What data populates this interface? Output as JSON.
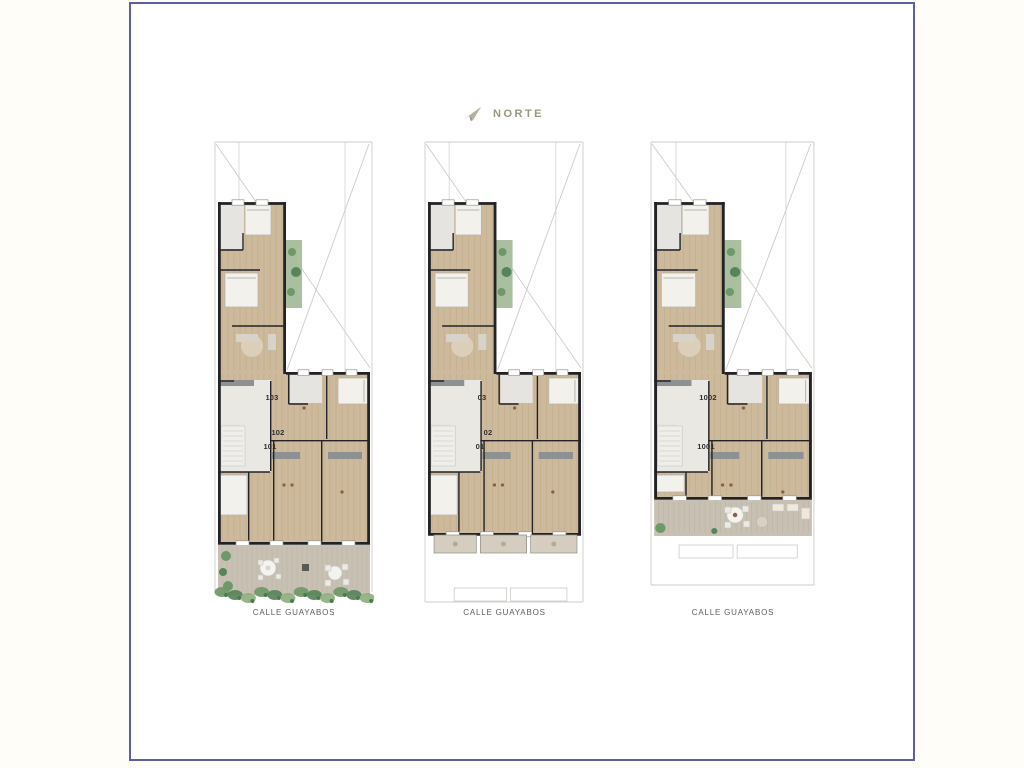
{
  "compass": {
    "label": "NORTE",
    "icon": "north-arrow-icon",
    "color": "#9a9780"
  },
  "plans": [
    {
      "name": "floor-plan-lower-level",
      "variant": "garden",
      "street_label": "CALLE GUAYABOS",
      "units": [
        {
          "label": "103"
        },
        {
          "label": "102"
        },
        {
          "label": "101"
        }
      ]
    },
    {
      "name": "floor-plan-typical-level",
      "variant": "balconies",
      "street_label": "CALLE GUAYABOS",
      "units": [
        {
          "label": "03"
        },
        {
          "label": "02"
        },
        {
          "label": "01"
        }
      ]
    },
    {
      "name": "floor-plan-tenth-level",
      "variant": "terrace",
      "street_label": "CALLE GUAYABOS",
      "units": [
        {
          "label": "1002"
        },
        {
          "label": "1001"
        }
      ]
    }
  ],
  "palette": {
    "frame": "#5c5fa0",
    "compass": "#9a9780",
    "wall": "#232327",
    "wood": "#cdb99b",
    "wood_line": "#bca886",
    "room": "#e6e4e0",
    "hall": "#eae8e3",
    "counter": "#8d9191",
    "bed": "#f3f1ec",
    "bed_stroke": "#b9b4ab",
    "rug": "#dccfba",
    "sofa": "#d8d3c9",
    "accent": "#8b5e42",
    "deck": "#c8c1b3",
    "deck_line": "#b7b0a2",
    "green_bg": "#aabfa0",
    "green": "#6f9868",
    "green_dark": "#58845a",
    "lot": "#cfccc6",
    "street_text": "#5f5f5f",
    "unit_text": "#2e2e33",
    "window_stroke": "#98968f",
    "outline": "#c9c7c1",
    "table": "#f4f3ef"
  }
}
